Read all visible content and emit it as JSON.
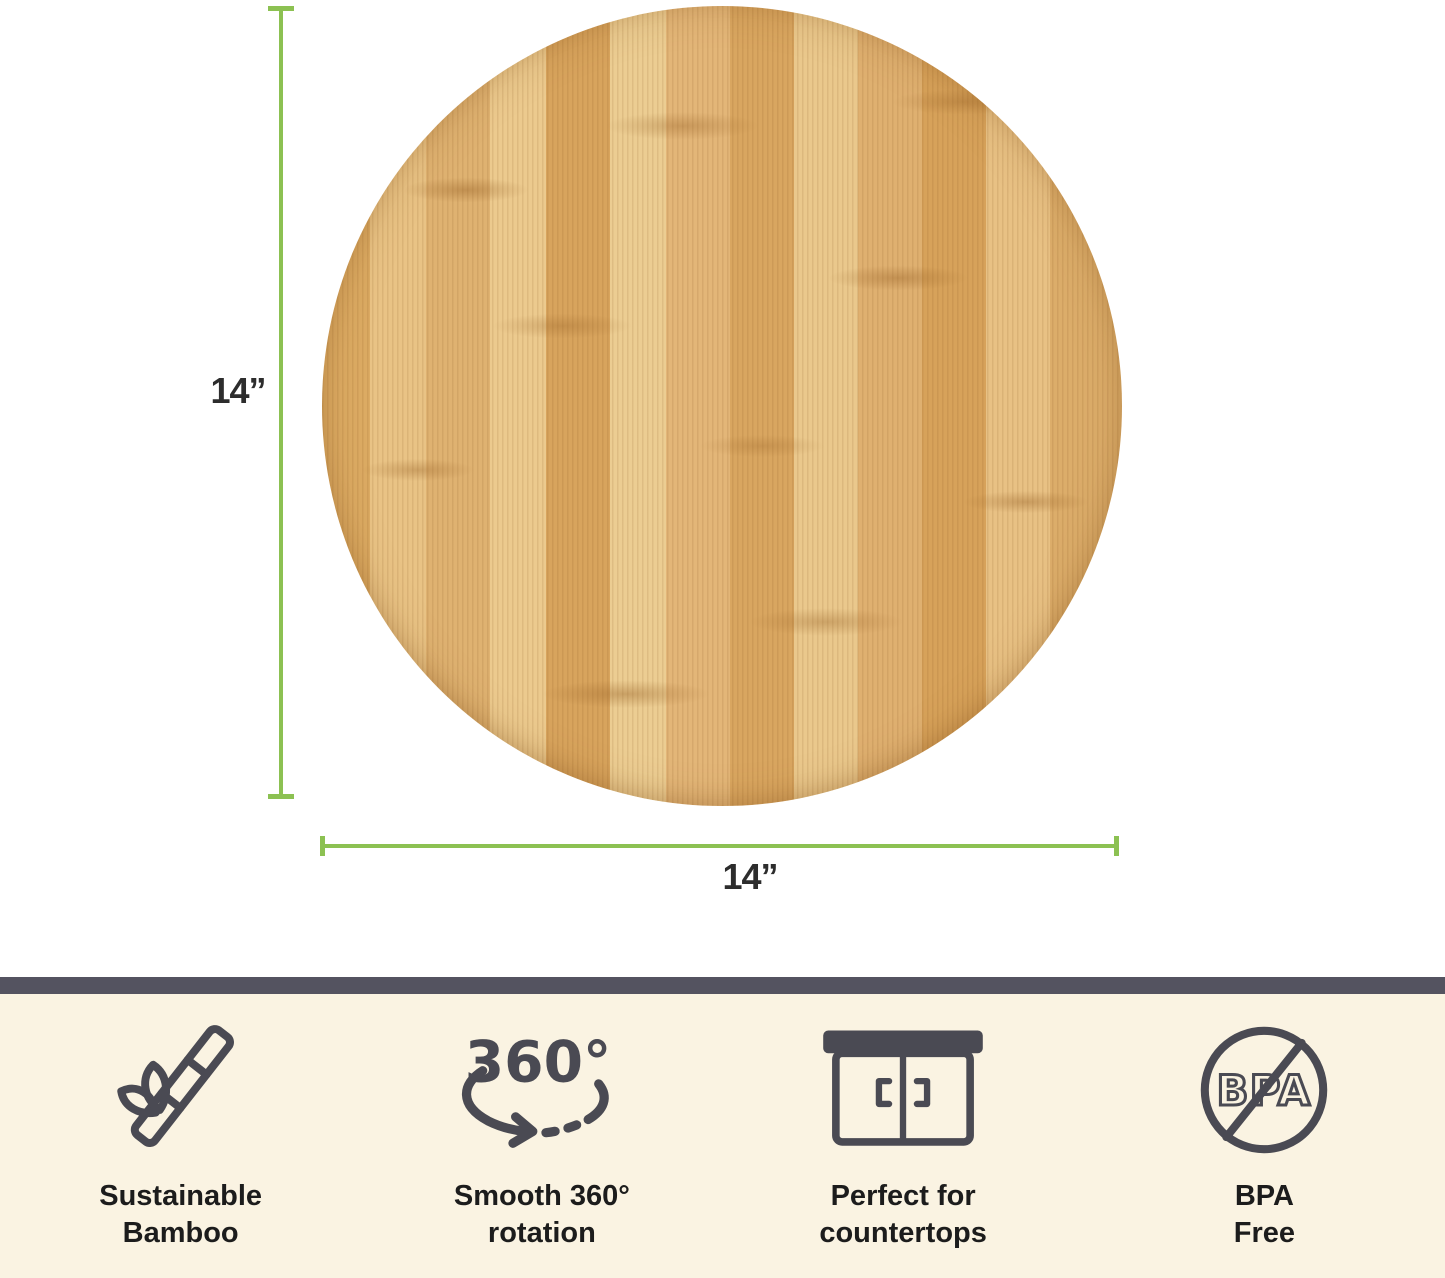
{
  "colors": {
    "dimension_green": "#8CC152",
    "strip_top_bar": "#545360",
    "strip_background": "#FAF3E2",
    "icon_stroke": "#4A4A53",
    "label_text": "#1C1C1C",
    "wood_light": "#ECCD92",
    "wood_mid": "#E0B273",
    "wood_dark": "#D7A25C"
  },
  "dimension_annotations": {
    "vertical_label": "14”",
    "horizontal_label": "14”"
  },
  "features": [
    {
      "icon": "bamboo-icon",
      "icon_text": "",
      "lines": [
        "Sustainable",
        "Bamboo"
      ]
    },
    {
      "icon": "rotation-360-icon",
      "icon_text": "360°",
      "lines": [
        "Smooth 360°",
        "rotation"
      ]
    },
    {
      "icon": "countertop-icon",
      "icon_text": "",
      "lines": [
        "Perfect for",
        "countertops"
      ]
    },
    {
      "icon": "bpa-free-icon",
      "icon_text": "BPA",
      "lines": [
        "BPA",
        "Free"
      ]
    }
  ]
}
